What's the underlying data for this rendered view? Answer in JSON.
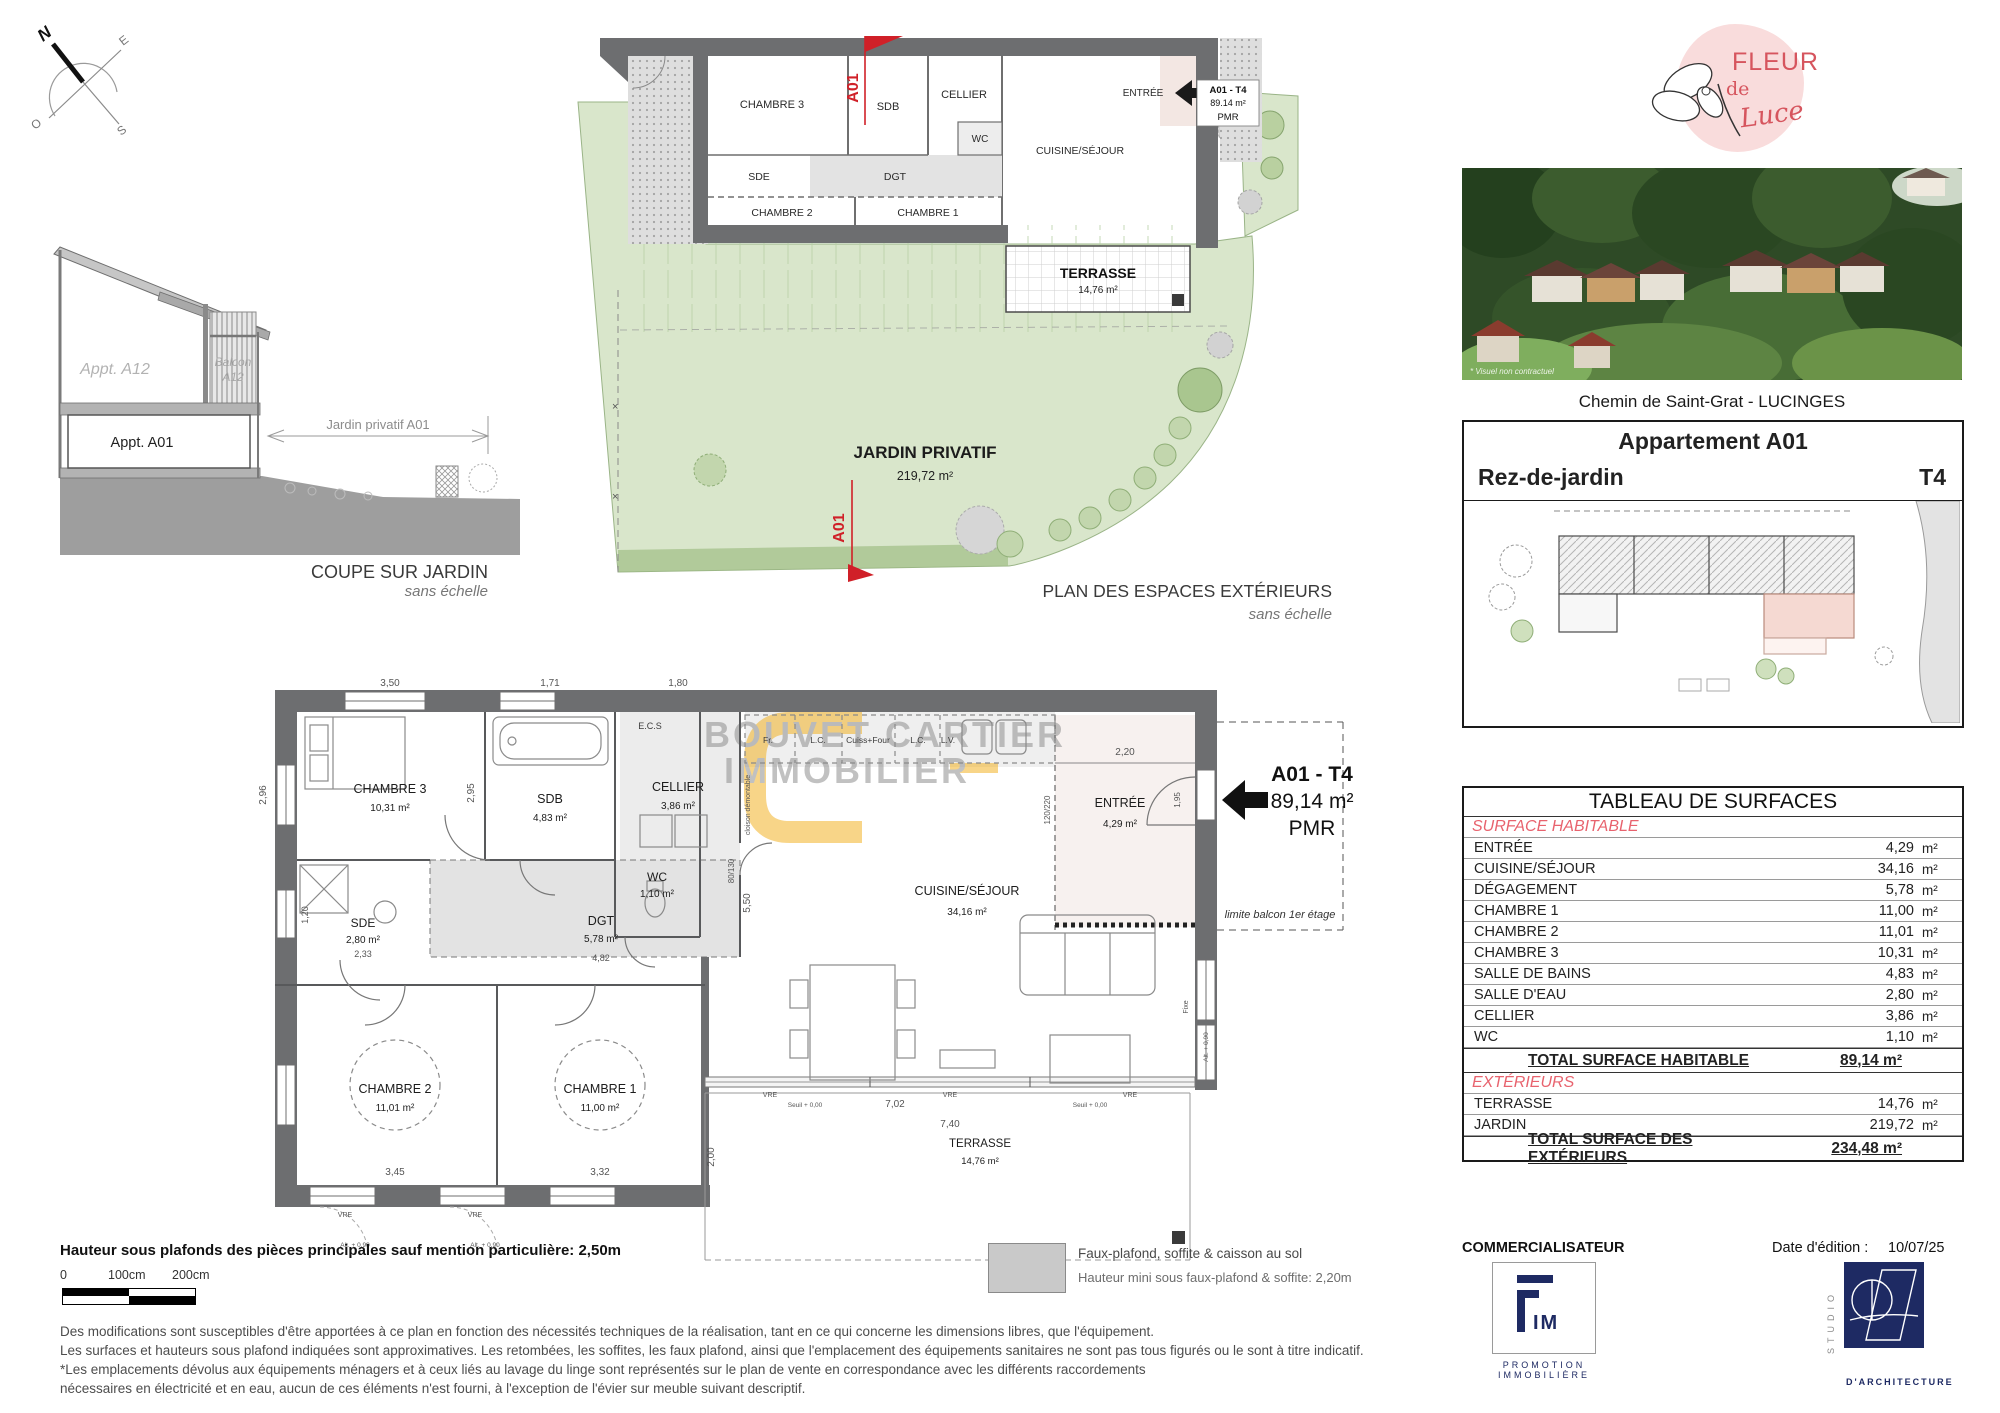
{
  "compass": {
    "n": "N",
    "e": "E",
    "s": "S",
    "o": "O"
  },
  "coupe": {
    "appt_a12": "Appt. A12",
    "balcon_line1": "Balcon",
    "balcon_line2": "A12",
    "appt_a01": "Appt. A01",
    "jardin_dim": "Jardin privatif A01",
    "title": "COUPE SUR JARDIN",
    "subtitle": "sans échelle"
  },
  "plan_ext": {
    "title": "PLAN DES ESPACES EXTÉRIEURS",
    "subtitle": "sans échelle",
    "jardin": "JARDIN PRIVATIF",
    "jardin_area": "219,72 m²",
    "terrasse": "TERRASSE",
    "terrasse_area": "14,76 m²",
    "marker": "A01",
    "unit": {
      "code": "A01 - T4",
      "area": "89.14 m²",
      "pmr": "PMR"
    },
    "rooms": {
      "chambre3": "CHAMBRE 3",
      "sdb": "SDB",
      "cellier": "CELLIER",
      "wc": "WC",
      "sde": "SDE",
      "dgt": "DGT",
      "chambre2": "CHAMBRE 2",
      "chambre1": "CHAMBRE 1",
      "cuisine": "CUISINE/SÉJOUR",
      "entree": "ENTRÉE"
    }
  },
  "plan_main": {
    "watermark1": "BOUVET CARTIER",
    "watermark2": "IMMOBILIER",
    "unit": {
      "code": "A01 - T4",
      "area": "89,14 m²",
      "pmr": "PMR"
    },
    "limite": "limite balcon 1er étage",
    "rooms": {
      "chambre3": {
        "name": "CHAMBRE 3",
        "area": "10,31 m²"
      },
      "sdb": {
        "name": "SDB",
        "area": "4,83 m²"
      },
      "cellier": {
        "name": "CELLIER",
        "area": "3,86 m²"
      },
      "wc": {
        "name": "WC",
        "area": "1,10 m²"
      },
      "sde": {
        "name": "SDE",
        "area": "2,80 m²"
      },
      "dgt": {
        "name": "DGT",
        "area": "5,78 m²"
      },
      "chambre2": {
        "name": "CHAMBRE 2",
        "area": "11,01 m²"
      },
      "chambre1": {
        "name": "CHAMBRE 1",
        "area": "11,00 m²"
      },
      "cuisine": {
        "name": "CUISINE/SÉJOUR",
        "area": "34,16 m²"
      },
      "entree": {
        "name": "ENTRÉE",
        "area": "4,29 m²"
      },
      "terrasse": {
        "name": "TERRASSE",
        "area": "14,76 m²"
      }
    },
    "kitchen": {
      "k1": "Fr.",
      "k2": "L.C.",
      "k3": "Cuiss+Four",
      "k4": "L.C.",
      "k5": "L.V."
    },
    "labels": {
      "ecs": "E.C.S",
      "cloison": "cloison démontable",
      "vre": "VRE",
      "fixe": "Fixe",
      "seuil": "Seuil + 0,00",
      "alt": "Alt. + 0,90",
      "pass": "80/130",
      "door": "120/220"
    },
    "dims": {
      "d350": "3,50",
      "d296": "2,96",
      "d295": "2,95",
      "d171": "1,71",
      "d180": "1,80",
      "d220": "2,20",
      "d195": "1,95",
      "d550": "5,50",
      "d482": "4,82",
      "d702": "7,02",
      "d740": "7,40",
      "d200": "2,00",
      "d345": "3,45",
      "d332": "3,32",
      "d233": "2,33",
      "d120": "1,20"
    }
  },
  "sidebar": {
    "logo": {
      "word1": "FLEUR",
      "word2": "de",
      "word3": "Luce"
    },
    "photo_note": "* Visuel non contractuel",
    "photo_caption": "Chemin de Saint-Grat - LUCINGES",
    "unit_box": {
      "title": "Appartement A01",
      "floor": "Rez-de-jardin",
      "type": "T4"
    },
    "table": {
      "title": "TABLEAU DE SURFACES",
      "section1": "SURFACE HABITABLE",
      "rows1": [
        {
          "label": "ENTRÉE",
          "value": "4,29",
          "unit": "m²"
        },
        {
          "label": "CUISINE/SÉJOUR",
          "value": "34,16",
          "unit": "m²"
        },
        {
          "label": "DÉGAGEMENT",
          "value": "5,78",
          "unit": "m²"
        },
        {
          "label": "CHAMBRE 1",
          "value": "11,00",
          "unit": "m²"
        },
        {
          "label": "CHAMBRE 2",
          "value": "11,01",
          "unit": "m²"
        },
        {
          "label": "CHAMBRE 3",
          "value": "10,31",
          "unit": "m²"
        },
        {
          "label": "SALLE DE BAINS",
          "value": "4,83",
          "unit": "m²"
        },
        {
          "label": "SALLE D'EAU",
          "value": "2,80",
          "unit": "m²"
        },
        {
          "label": "CELLIER",
          "value": "3,86",
          "unit": "m²"
        },
        {
          "label": "WC",
          "value": "1,10",
          "unit": "m²"
        }
      ],
      "total1": {
        "label": "TOTAL SURFACE HABITABLE",
        "value": "89,14 m²"
      },
      "section2": "EXTÉRIEURS",
      "rows2": [
        {
          "label": "TERRASSE",
          "value": "14,76",
          "unit": "m²"
        },
        {
          "label": "JARDIN",
          "value": "219,72",
          "unit": "m²"
        }
      ],
      "total2": {
        "label": "TOTAL SURFACE DES EXTÉRIEURS",
        "value": "234,48 m²"
      }
    }
  },
  "footer": {
    "height_note": "Hauteur sous plafonds des pièces principales sauf mention particulière: 2,50m",
    "scale": {
      "s0": "0",
      "s1": "100cm",
      "s2": "200cm"
    },
    "legend": {
      "line1": "Faux-plafond, soffite & caisson au sol",
      "line2": "Hauteur mini sous faux-plafond & soffite: 2,20m"
    },
    "notes": {
      "l1": "Des modifications sont susceptibles d'être apportées à ce plan en fonction des nécessités techniques de la réalisation, tant en ce qui concerne les dimensions libres, que l'équipement.",
      "l2": "Les surfaces et hauteurs sous plafond indiquées sont approximatives. Les retombées, les soffites, les faux plafond, ainsi que l'emplacement des équipements sanitaires ne sont pas tous figurés ou le sont à titre indicatif.",
      "l3": "*Les emplacements dévolus aux équipements ménagers et à ceux liés au lavage du linge sont représentés sur le plan de vente en correspondance avec les différents raccordements",
      "l4": "nécessaires en électricité et en eau, aucun de ces éléments n'est fourni, à l'exception de l'évier sur meuble suivant descriptif."
    },
    "commercialisateur": "COMMERCIALISATEUR",
    "fim": {
      "letters": "IM",
      "sub1": "PROMOTION",
      "sub2": "IMMOBILIÈRE"
    },
    "date_label": "Date d'édition :",
    "date_value": "10/07/25",
    "studio": {
      "vertical": "STUDIO",
      "name": "D'ARCHITECTURE"
    }
  },
  "colors": {
    "wall": "#6d6e70",
    "green": "#d9e6cb",
    "red": "#d02028",
    "table_red": "#e8636e",
    "navy": "#1e2a63",
    "logo_pink": "#f9dcdc",
    "logo_red": "#d6555e",
    "orange": "#f0a500"
  }
}
